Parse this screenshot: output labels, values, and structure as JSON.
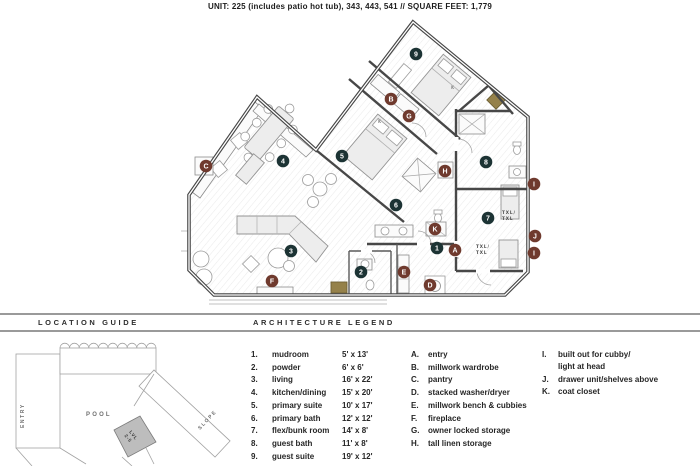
{
  "title": "UNIT: 225 (includes patio hot tub), 343, 443, 541  //  SQUARE FEET: 1,779",
  "location_guide": {
    "header": "LOCATION GUIDE",
    "labels": {
      "entry": "ENTRY",
      "pool": "POOL",
      "slope": "SLOPE",
      "level_line1": "LVL",
      "level_line2": "2-5"
    }
  },
  "legend": {
    "header": "ARCHITECTURE LEGEND",
    "rooms": [
      {
        "num": "1.",
        "name": "mudroom",
        "dim": "5' x 13'"
      },
      {
        "num": "2.",
        "name": "powder",
        "dim": "6' x 6'"
      },
      {
        "num": "3.",
        "name": "living",
        "dim": "16' x 22'"
      },
      {
        "num": "4.",
        "name": "kitchen/dining",
        "dim": "15' x 20'"
      },
      {
        "num": "5.",
        "name": "primary suite",
        "dim": "10' x 17'"
      },
      {
        "num": "6.",
        "name": "primary bath",
        "dim": "12' x 12'"
      },
      {
        "num": "7.",
        "name": "flex/bunk room",
        "dim": "14' x 8'"
      },
      {
        "num": "8.",
        "name": "guest bath",
        "dim": "11' x 8'"
      },
      {
        "num": "9.",
        "name": "guest suite",
        "dim": "19' x 12'"
      }
    ],
    "features": [
      {
        "letter": "A.",
        "name": "entry"
      },
      {
        "letter": "B.",
        "name": "millwork wardrobe"
      },
      {
        "letter": "C.",
        "name": "pantry"
      },
      {
        "letter": "D.",
        "name": "stacked washer/dryer"
      },
      {
        "letter": "E.",
        "name": "millwork bench & cubbies"
      },
      {
        "letter": "F.",
        "name": "fireplace"
      },
      {
        "letter": "G.",
        "name": "owner locked storage"
      },
      {
        "letter": "H.",
        "name": "tall linen storage"
      }
    ],
    "features_right": [
      {
        "letter": "I.",
        "lines": [
          "built out for cubby/",
          "light at head"
        ]
      },
      {
        "letter": "J.",
        "lines": [
          "drawer unit/shelves above"
        ]
      },
      {
        "letter": "K.",
        "lines": [
          "coat closet"
        ]
      }
    ]
  },
  "floorplan": {
    "colors": {
      "room_marker": "#1c3334",
      "feature_marker": "#6f3a2e",
      "accent_gold": "#95814a",
      "wall": "#474747"
    },
    "markers": [
      {
        "id": "9",
        "type": "room",
        "x": 237,
        "y": 35
      },
      {
        "id": "5",
        "type": "room",
        "x": 163,
        "y": 137
      },
      {
        "id": "4",
        "type": "room",
        "x": 104,
        "y": 142
      },
      {
        "id": "3",
        "type": "room",
        "x": 112,
        "y": 232
      },
      {
        "id": "2",
        "type": "room",
        "x": 182,
        "y": 253
      },
      {
        "id": "1",
        "type": "room",
        "x": 258,
        "y": 229
      },
      {
        "id": "6",
        "type": "room",
        "x": 217,
        "y": 186
      },
      {
        "id": "7",
        "type": "room",
        "x": 309,
        "y": 199
      },
      {
        "id": "8",
        "type": "room",
        "x": 307,
        "y": 143
      },
      {
        "id": "A",
        "type": "feature",
        "x": 276,
        "y": 231
      },
      {
        "id": "B",
        "type": "feature",
        "x": 212,
        "y": 80
      },
      {
        "id": "C",
        "type": "feature",
        "x": 27,
        "y": 147
      },
      {
        "id": "D",
        "type": "feature",
        "x": 251,
        "y": 266
      },
      {
        "id": "E",
        "type": "feature",
        "x": 225,
        "y": 253
      },
      {
        "id": "F",
        "type": "feature",
        "x": 93,
        "y": 262
      },
      {
        "id": "G",
        "type": "feature",
        "x": 230,
        "y": 97
      },
      {
        "id": "H",
        "type": "feature",
        "x": 266,
        "y": 152
      },
      {
        "id": "I",
        "type": "feature",
        "x": 355,
        "y": 165
      },
      {
        "id": "J",
        "type": "feature",
        "x": 356,
        "y": 217
      },
      {
        "id": "I",
        "type": "feature",
        "x": 355,
        "y": 234
      },
      {
        "id": "K",
        "type": "feature",
        "x": 256,
        "y": 210
      }
    ],
    "bed_labels": [
      {
        "text": "K",
        "x": 272,
        "y": 70
      },
      {
        "text": "K",
        "x": 199,
        "y": 104
      }
    ],
    "bunk_labels": [
      {
        "lines": [
          "TXL/",
          "TXL"
        ],
        "x": 323,
        "y": 195
      },
      {
        "lines": [
          "TXL/",
          "TXL"
        ],
        "x": 297,
        "y": 229
      }
    ]
  }
}
